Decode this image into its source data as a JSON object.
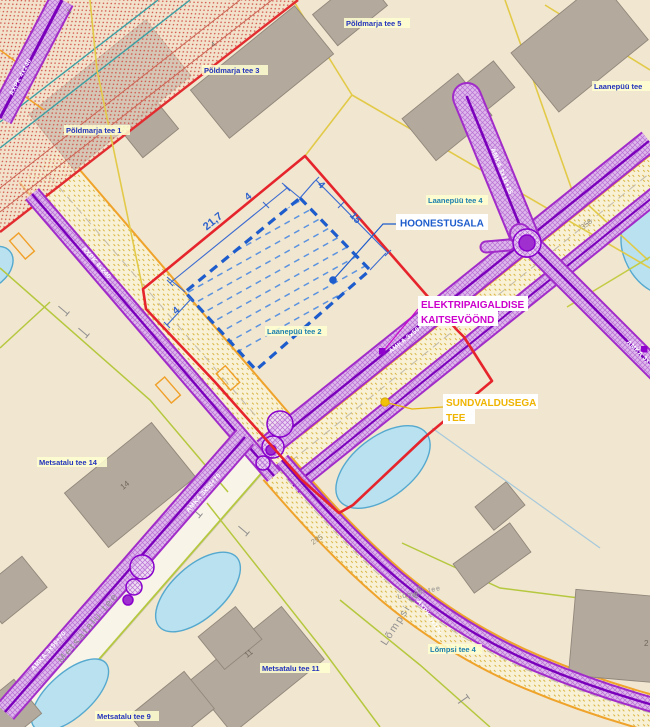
{
  "map": {
    "callouts": {
      "hoonestusala": "HOONESTUSALA",
      "kaitsevoond_line1": "ELEKTRIPAIGALDISE",
      "kaitsevoond_line2": "KAITSEVÖÖND",
      "sundvaldus_line1": "SUNDVALDUSEGA",
      "sundvaldus_line2": "TEE"
    },
    "dimensions": {
      "long_side": "21,7",
      "short_side": "15",
      "offset": "4"
    },
    "addresses": [
      {
        "text": "Põldmarja tee 5"
      },
      {
        "text": "Põldmarja tee 3"
      },
      {
        "text": "Põldmarja tee 1"
      },
      {
        "text": "Laanepüü tee"
      },
      {
        "text": "Laanepüü tee 4"
      },
      {
        "text": "Laanepüü tee 2"
      },
      {
        "text": "Metsatalu tee 14"
      },
      {
        "text": "Metsatalu tee 11"
      },
      {
        "text": "Metsatalu tee 9"
      },
      {
        "text": "Lõmpsi tee 4"
      }
    ],
    "road_names": {
      "metsatalu": "Metsatalu tee",
      "lompsi": "Lõmpsi tee",
      "lompsi_small": "Lõmpsi tee"
    },
    "parcel_numbers": {
      "p358": "358",
      "p295": "295"
    },
    "building_numbers": {
      "b14": "14",
      "b11": "11",
      "b2": "2",
      "b1": "1",
      "b4": "4"
    },
    "cables": {
      "amka_50_70": "AMKA 3x50+70",
      "amka_16_25": "AMKA 3x16+25",
      "axpk_240": "AXPK 4x240",
      "axpk_120": "AXPK 3x120"
    },
    "colors": {
      "hoonestusala_blue": "#1d5ccc",
      "kaitsevoond_magenta": "#cc00cc",
      "sundvaldus_yellow": "#efb400",
      "corridor_purple": "#a12cc9",
      "boundary_red": "#e6242c",
      "background_beige": "#f1e6d0"
    }
  }
}
